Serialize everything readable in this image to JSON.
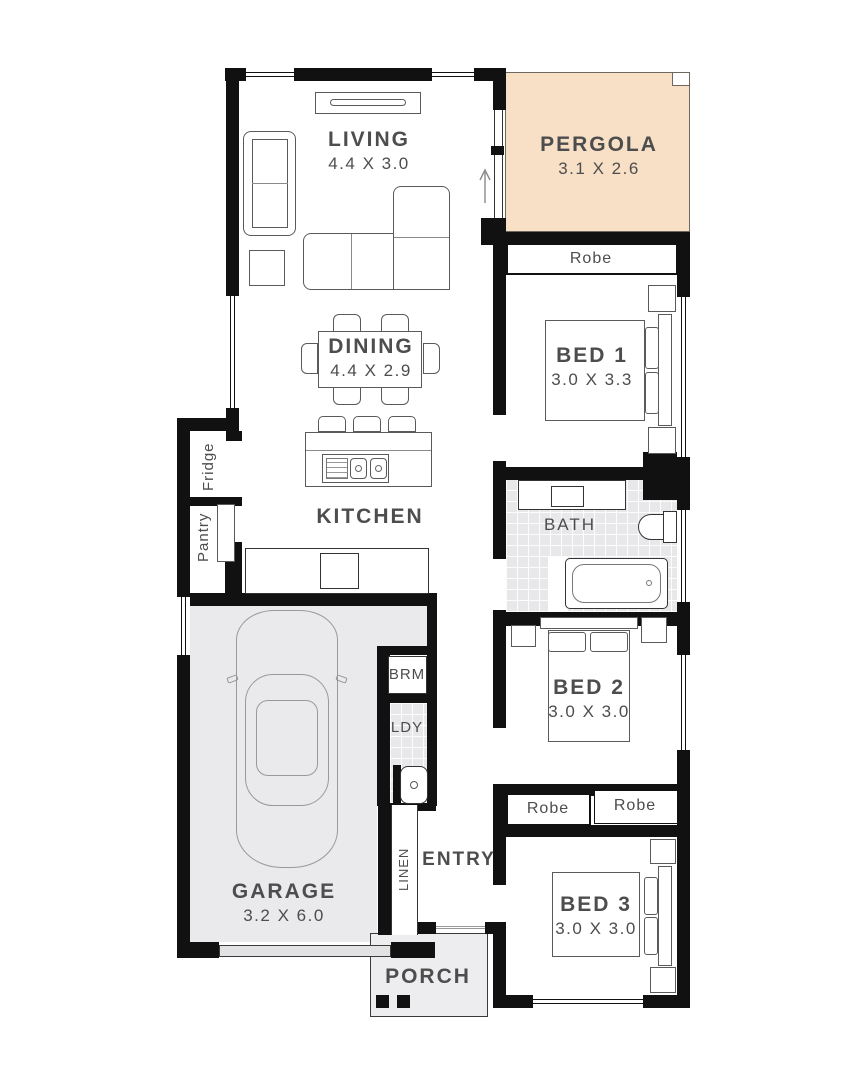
{
  "rooms": {
    "living": {
      "name": "LIVING",
      "dims": "4.4 X 3.0"
    },
    "pergola": {
      "name": "PERGOLA",
      "dims": "3.1 X 2.6"
    },
    "dining": {
      "name": "DINING",
      "dims": "4.4 X 2.9"
    },
    "kitchen": {
      "name": "KITCHEN"
    },
    "bed1": {
      "name": "BED 1",
      "dims": "3.0 X 3.3"
    },
    "bath": {
      "name": "BATH"
    },
    "bed2": {
      "name": "BED 2",
      "dims": "3.0 X 3.0"
    },
    "bed3": {
      "name": "BED 3",
      "dims": "3.0 X 3.0"
    },
    "garage": {
      "name": "GARAGE",
      "dims": "3.2 X 6.0"
    },
    "entry": {
      "name": "ENTRY"
    },
    "porch": {
      "name": "PORCH"
    },
    "broom": {
      "name": "BRM"
    },
    "laundry": {
      "name": "LDY"
    },
    "linen": {
      "name": "LINEN"
    },
    "fridge": {
      "name": "Fridge"
    },
    "pantry": {
      "name": "Pantry"
    },
    "robe_bed1": {
      "name": "Robe"
    },
    "robe_bed3_left": {
      "name": "Robe"
    },
    "robe_bed3_right": {
      "name": "Robe"
    }
  },
  "colors": {
    "wall": "#111111",
    "pergola": "#F8E0C7",
    "floor": "#EAEAEC",
    "porch": "#EDEDEF",
    "label": "#4D4D4D"
  }
}
